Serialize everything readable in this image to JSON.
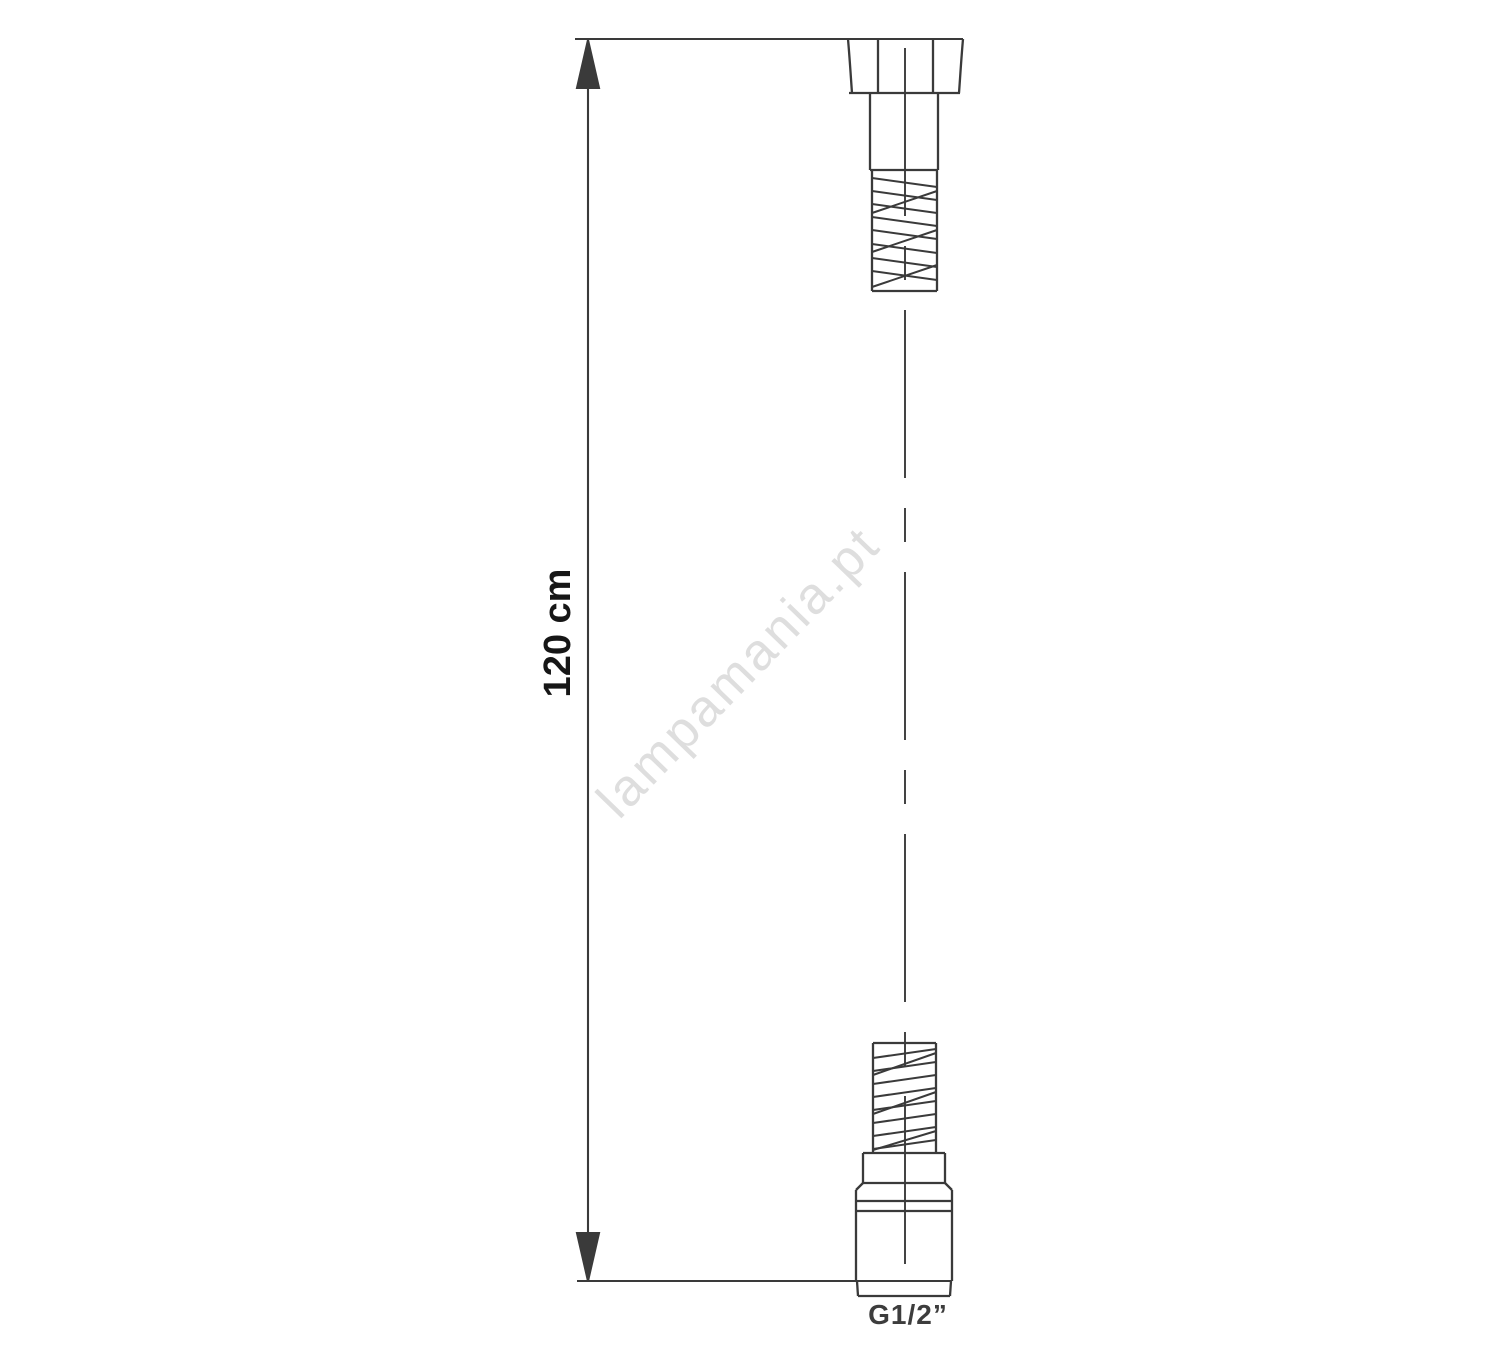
{
  "diagram": {
    "title": "shower-hose-technical-drawing",
    "dimension_label": "120 cm",
    "thread_label": "G1/2”",
    "watermark": "lampamania.pt",
    "line_color": "#3a3a3a",
    "dimension_text_color": "#161616",
    "thread_label_color": "#3d3d3d",
    "watermark_color": "#dedede",
    "background_color": "#ffffff"
  }
}
